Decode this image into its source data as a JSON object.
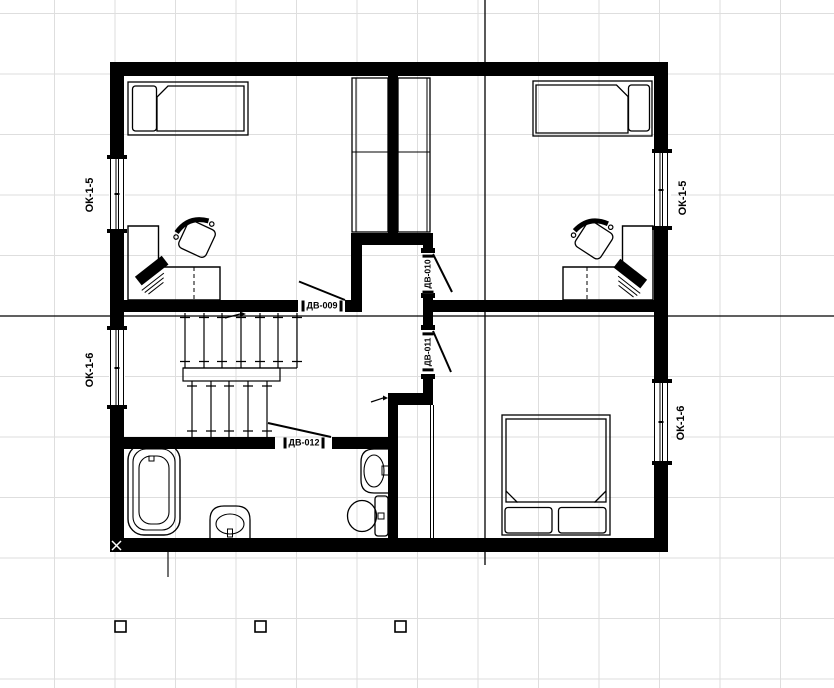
{
  "drawing": {
    "type": "architectural-floor-plan",
    "colors": {
      "background": "#ffffff",
      "grid": "#dedede",
      "ink": "#000000"
    },
    "windows": [
      {
        "label": "ОК-1-5",
        "side": "left",
        "position": "top"
      },
      {
        "label": "ОК-1-6",
        "side": "left",
        "position": "bottom"
      },
      {
        "label": "ОК-1-5",
        "side": "right",
        "position": "top"
      },
      {
        "label": "ОК-1-6",
        "side": "right",
        "position": "bottom"
      }
    ],
    "doors": [
      {
        "label": "ДВ-009",
        "orientation": "horizontal"
      },
      {
        "label": "ДВ-010",
        "orientation": "vertical"
      },
      {
        "label": "ДВ-011",
        "orientation": "vertical"
      },
      {
        "label": "ДВ-012",
        "orientation": "horizontal"
      }
    ],
    "objects": {
      "bedroom_top_left": [
        "single-bed",
        "wardrobe",
        "corner-desk",
        "desk-chair",
        "keyboard"
      ],
      "bedroom_top_right": [
        "single-bed",
        "wardrobe",
        "corner-desk",
        "desk-chair",
        "keyboard"
      ],
      "bedroom_bottom_right": [
        "double-bed"
      ],
      "bathroom": [
        "bathtub",
        "pedestal-sink",
        "washbasin",
        "toilet"
      ],
      "hall": [
        "staircase"
      ]
    }
  }
}
